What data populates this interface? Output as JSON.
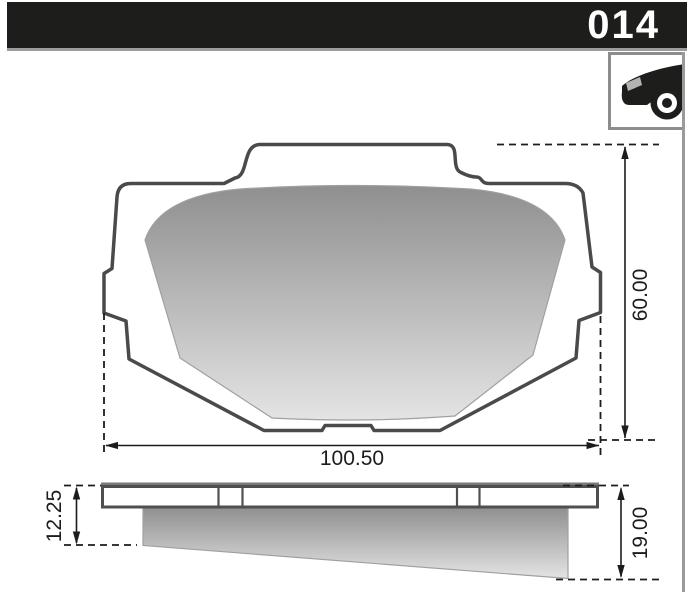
{
  "header": {
    "part_number": "014"
  },
  "vehicle_icon": {
    "name": "car-front-icon"
  },
  "dimensions": {
    "front_width": "100.50",
    "front_height": "60.00",
    "side_left_thickness": "12.25",
    "side_right_thickness": "19.00"
  },
  "colors": {
    "header_bg": "#1d1d1b",
    "outline": "#4a4a4a",
    "dimension": "#1c1c1c",
    "friction_dark": "#8f8f8f",
    "friction_light": "#e4e4e4",
    "rule_gray": "#9a9a9a"
  }
}
